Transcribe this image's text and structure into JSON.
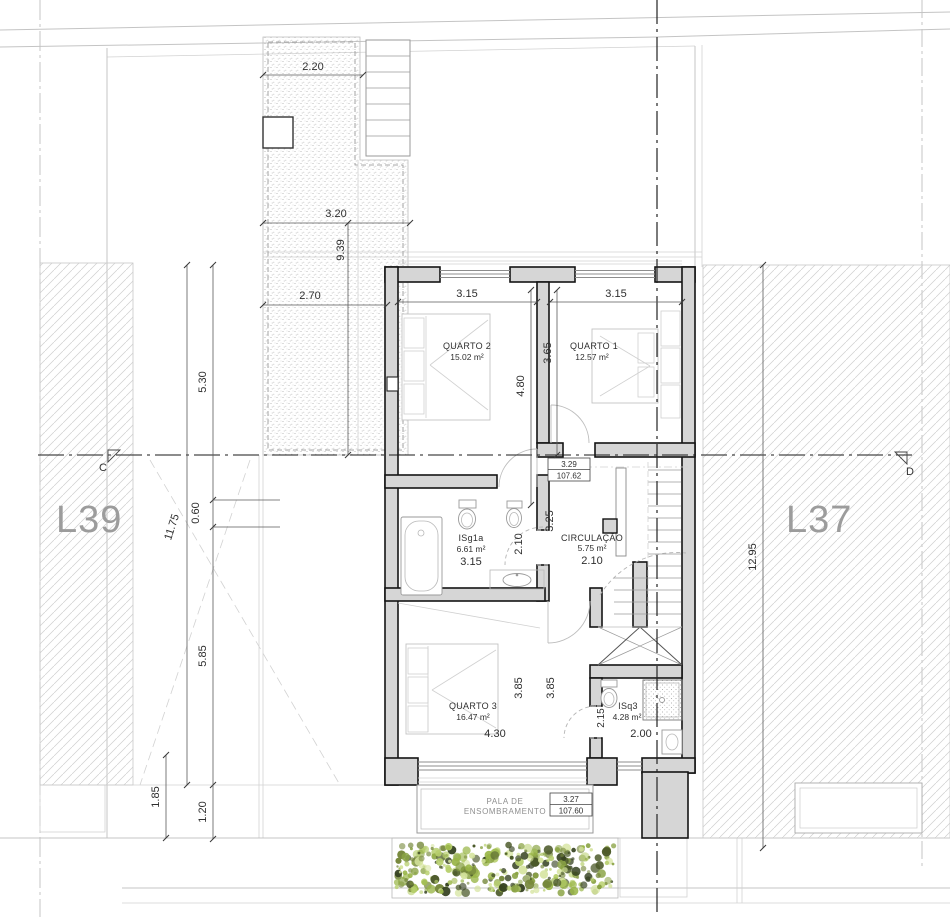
{
  "meta": {
    "drawing_type": "architectural floor plan (upper floor)"
  },
  "lots": {
    "left": "L39",
    "right": "L37"
  },
  "section": {
    "left": "C",
    "right": "D"
  },
  "rooms": {
    "quarto2": {
      "name": "QUARTO 2",
      "area": "15.02 m²"
    },
    "quarto1": {
      "name": "QUARTO 1",
      "area": "12.57 m²"
    },
    "quarto3": {
      "name": "QUARTO 3",
      "area": "16.47 m²"
    },
    "circulacao": {
      "name": "CIRCULAÇÃO",
      "area": "5.75 m²"
    },
    "isg1a": {
      "name": "ISg1a",
      "area": "6.61 m²"
    },
    "isq3": {
      "name": "ISq3",
      "area": "4.28 m²"
    }
  },
  "pala": {
    "line1": "PALA DE",
    "line2": "ENSOMBRAMENTO"
  },
  "levels": {
    "interior": {
      "height": "3.29",
      "elevation": "107.62"
    },
    "exterior": {
      "height": "3.27",
      "elevation": "107.60"
    }
  },
  "dims": {
    "terrace_w1": "2.20",
    "terrace_w2": "3.20",
    "terrace_w3": "2.70",
    "terrace_h": "9.39",
    "left_total": "11.75",
    "left_a": "5.30",
    "left_b": "0.60",
    "left_c": "5.85",
    "left_d": "1.85",
    "left_e": "1.20",
    "right_total": "12.95",
    "q2_w": "3.15",
    "q1_w": "3.15",
    "q2_h": "4.80",
    "q1_h": "3.65",
    "bath_w": "3.15",
    "bath_h": "2.10",
    "hall_w": "2.10",
    "hall_h": "3.25",
    "q3_w": "4.30",
    "q3_h1": "3.85",
    "q3_h2": "3.85",
    "isq3_w": "2.00",
    "isq3_h": "2.15"
  },
  "colors": {
    "wall_fill": "#d6d6d6",
    "wall_line": "#141414",
    "hatch_line": "#cfcfcf",
    "dim_text": "#2f2f2f",
    "lot_label": "#9c9c9c",
    "hedge": [
      "#b7cf6d",
      "#9ab648",
      "#76883b",
      "#4c5a2a",
      "#d4e39b",
      "#333f1e",
      "#8aa344"
    ]
  }
}
